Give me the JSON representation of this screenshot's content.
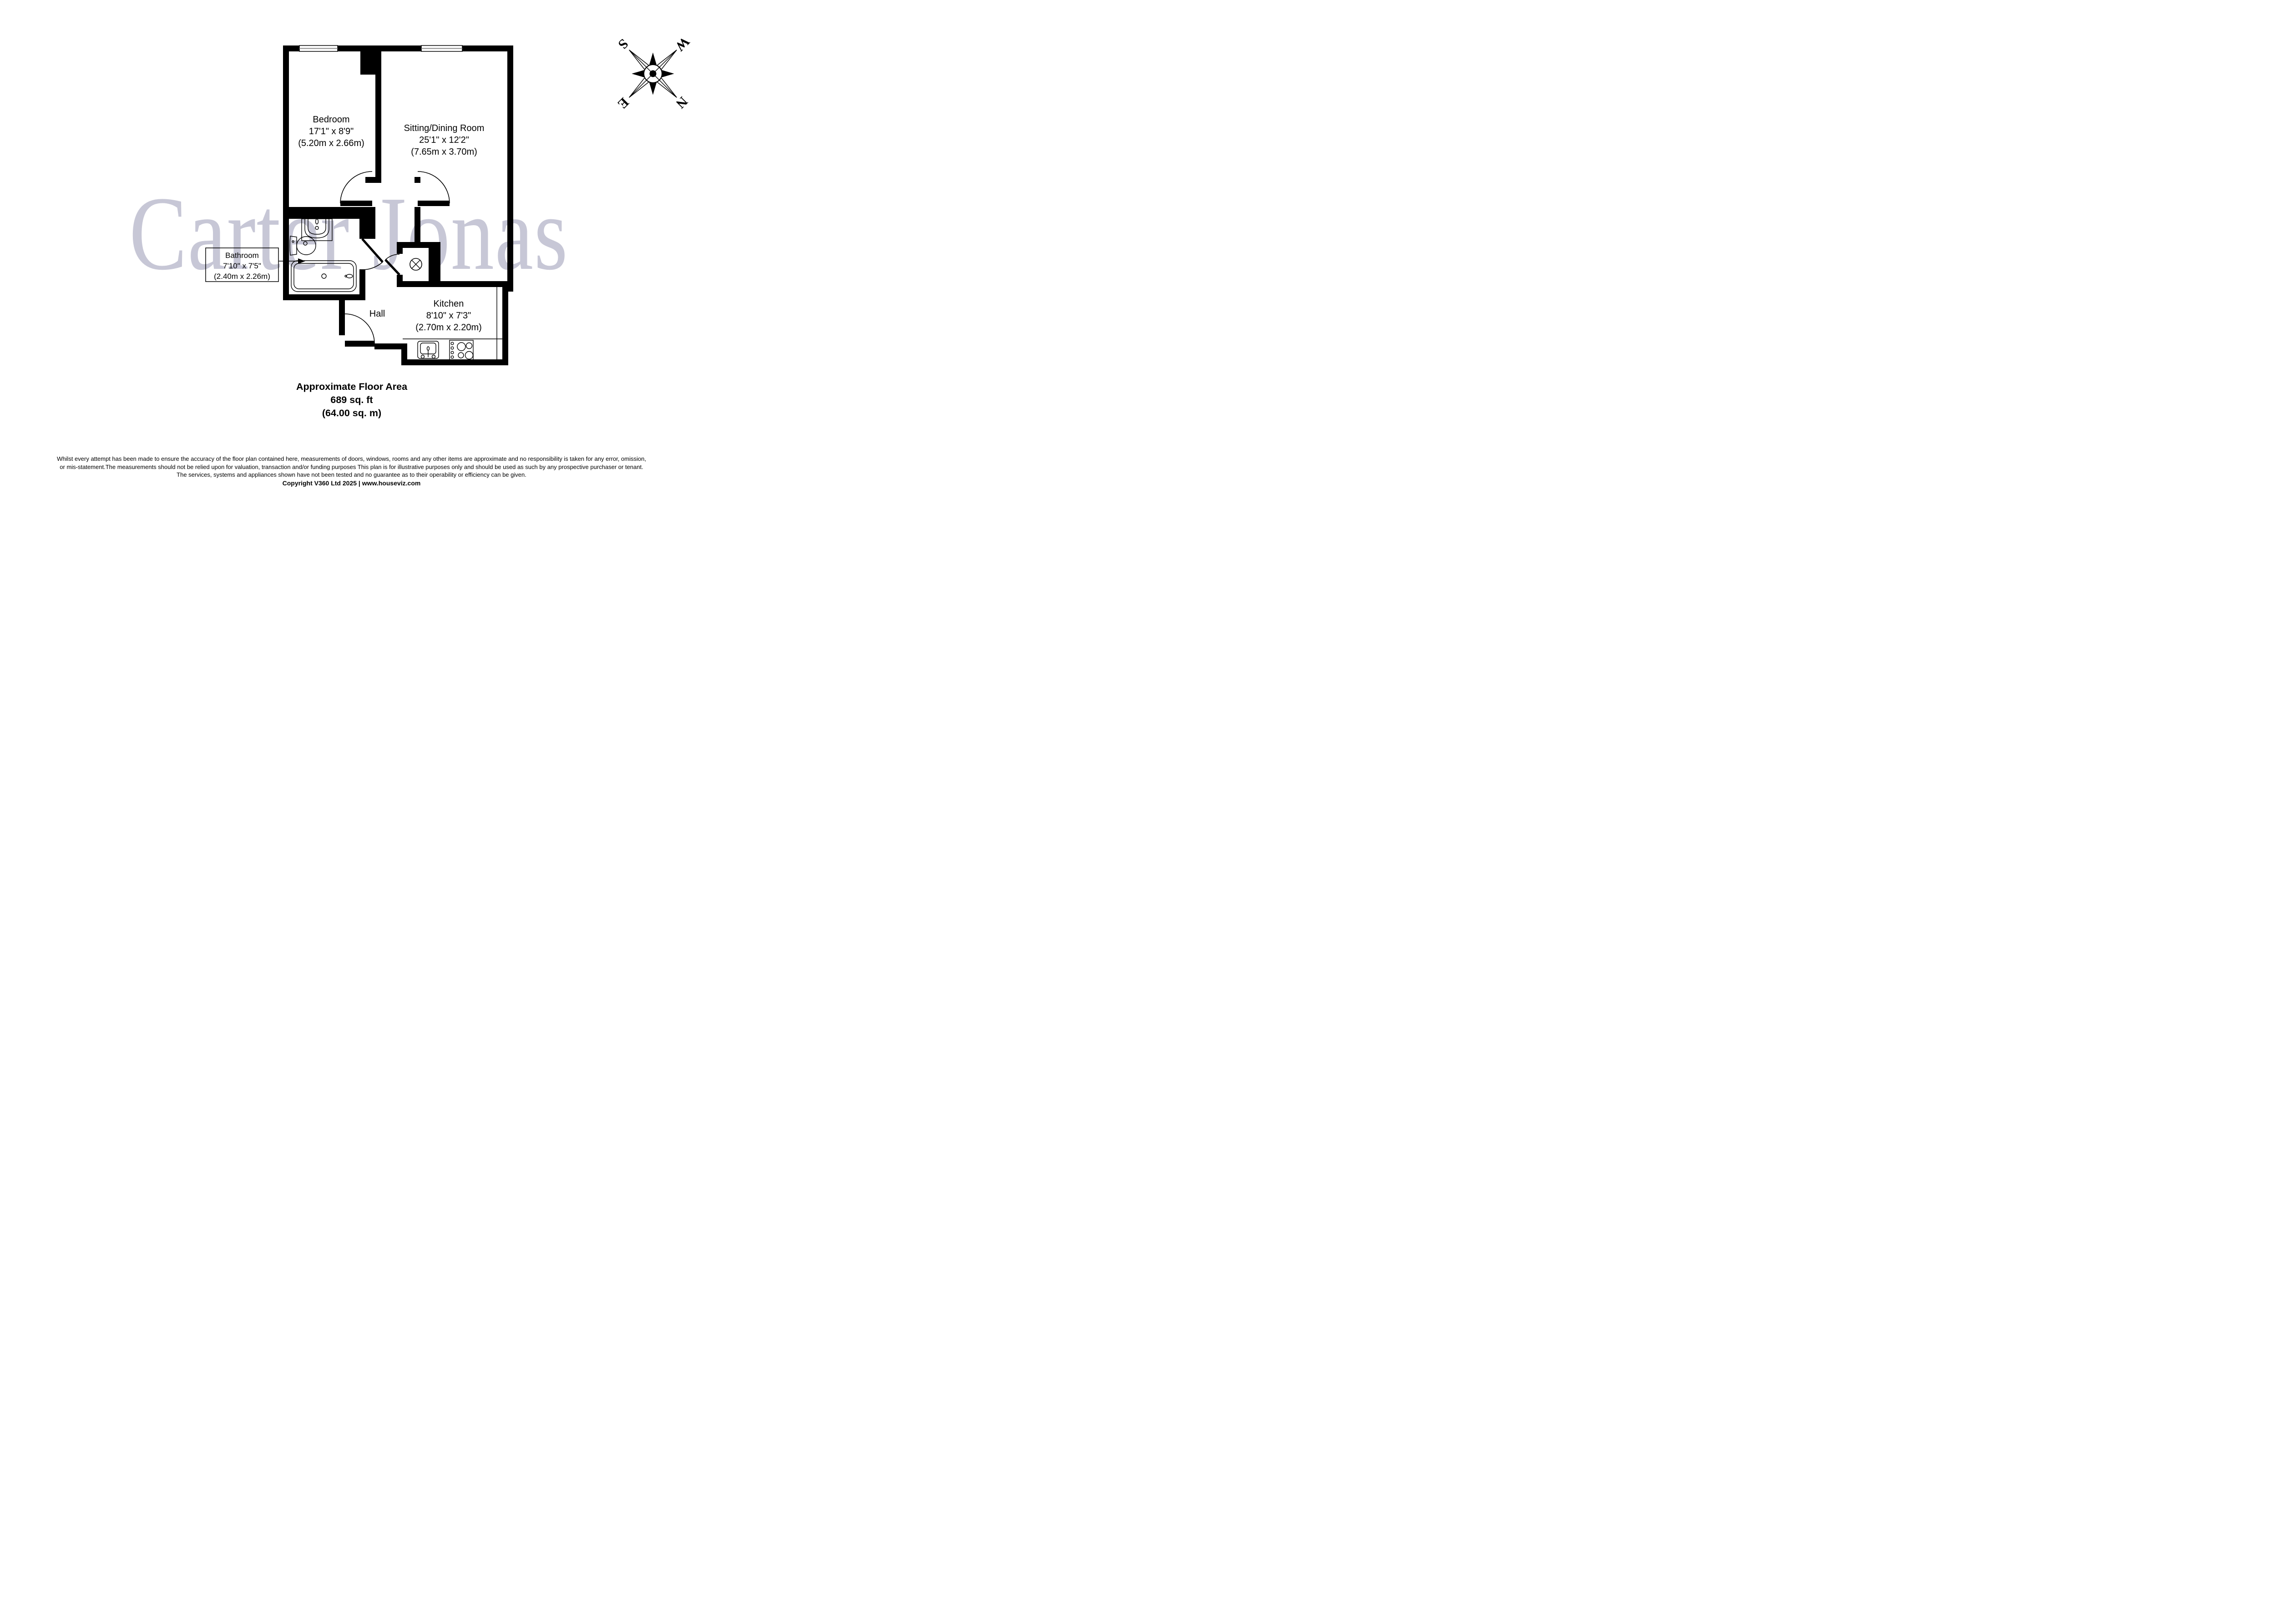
{
  "watermark": {
    "text": "Carter Jonas"
  },
  "rooms": {
    "bedroom": {
      "name": "Bedroom",
      "imperial": "17'1\" x 8'9\"",
      "metric": "(5.20m x 2.66m)"
    },
    "sitting": {
      "name": "Sitting/Dining Room",
      "imperial": "25'1\" x 12'2\"",
      "metric": "(7.65m x 3.70m)"
    },
    "bathroom": {
      "name": "Bathroom",
      "imperial": "7'10\" x 7'5\"",
      "metric": "(2.40m x 2.26m)"
    },
    "kitchen": {
      "name": "Kitchen",
      "imperial": "8'10\" x 7'3\"",
      "metric": "(2.70m x 2.20m)"
    },
    "hall": {
      "name": "Hall"
    }
  },
  "area": {
    "title": "Approximate Floor Area",
    "imperial": "689 sq. ft",
    "metric": "(64.00 sq. m)"
  },
  "compass": {
    "n": "N",
    "s": "S",
    "e": "E",
    "w": "W"
  },
  "footer": {
    "line1": "Whilst every attempt has been made to ensure the accuracy of the floor plan contained here, measurements of doors, windows, rooms and any other items are approximate and no responsibility is taken for any error, omission,",
    "line2": "or mis-statement.The measurements should not be relied upon for valuation, transaction and/or funding purposes This plan is for illustrative purposes only and should be used as such by any prospective purchaser or tenant.",
    "line3": "The services, systems and appliances shown have not been tested and no guarantee as to their operability or efficiency can be given.",
    "copyright": "Copyright V360 Ltd 2025 | www.houseviz.com"
  },
  "colors": {
    "wall": "#000000",
    "watermark": "#c7c7d6",
    "window_line": "#8a8a8a"
  }
}
